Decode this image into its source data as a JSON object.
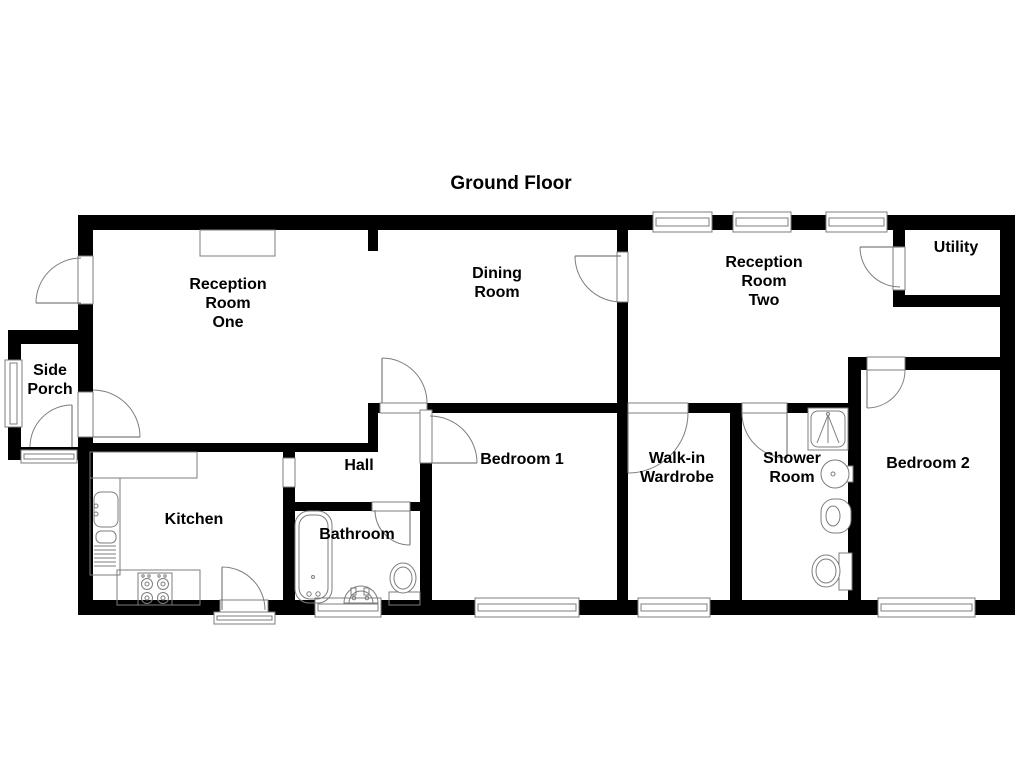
{
  "title": {
    "text": "Ground Floor",
    "x": 511,
    "y": 189
  },
  "colors": {
    "wall": "#000000",
    "line": "#7d7d7d",
    "bg": "#ffffff",
    "text": "#000000"
  },
  "canvas": {
    "w": 1024,
    "h": 768
  },
  "rooms": [
    {
      "id": "reception-room-one",
      "lines": [
        "Reception",
        "Room",
        "One"
      ],
      "x": 228,
      "y": 289
    },
    {
      "id": "dining-room",
      "lines": [
        "Dining",
        "Room"
      ],
      "x": 497,
      "y": 278
    },
    {
      "id": "reception-room-two",
      "lines": [
        "Reception",
        "Room",
        "Two"
      ],
      "x": 764,
      "y": 267
    },
    {
      "id": "utility",
      "lines": [
        "Utility"
      ],
      "x": 956,
      "y": 252
    },
    {
      "id": "side-porch",
      "lines": [
        "Side",
        "Porch"
      ],
      "x": 50,
      "y": 375
    },
    {
      "id": "kitchen",
      "lines": [
        "Kitchen"
      ],
      "x": 194,
      "y": 524
    },
    {
      "id": "hall",
      "lines": [
        "Hall"
      ],
      "x": 359,
      "y": 470
    },
    {
      "id": "bathroom",
      "lines": [
        "Bathroom"
      ],
      "x": 357,
      "y": 539
    },
    {
      "id": "bedroom-1",
      "lines": [
        "Bedroom 1"
      ],
      "x": 522,
      "y": 464
    },
    {
      "id": "walk-in-wardrobe",
      "lines": [
        "Walk-in",
        "Wardrobe"
      ],
      "x": 677,
      "y": 463
    },
    {
      "id": "shower-room",
      "lines": [
        "Shower",
        "Room"
      ],
      "x": 792,
      "y": 463
    },
    {
      "id": "bedroom-2",
      "lines": [
        "Bedroom 2"
      ],
      "x": 928,
      "y": 468
    }
  ],
  "walls": [
    {
      "id": "exterior-top",
      "x": 78,
      "y": 215,
      "w": 937,
      "h": 15
    },
    {
      "id": "exterior-west",
      "x": 78,
      "y": 215,
      "w": 15,
      "h": 400
    },
    {
      "id": "exterior-east",
      "x": 1000,
      "y": 215,
      "w": 15,
      "h": 400
    },
    {
      "id": "exterior-bottom",
      "x": 78,
      "y": 600,
      "w": 937,
      "h": 15
    },
    {
      "id": "porch-top",
      "x": 8,
      "y": 330,
      "w": 78,
      "h": 14
    },
    {
      "id": "porch-west",
      "x": 8,
      "y": 330,
      "w": 13,
      "h": 130
    },
    {
      "id": "porch-bottom",
      "x": 8,
      "y": 447,
      "w": 70,
      "h": 13
    },
    {
      "id": "reception-one-south",
      "x": 85,
      "y": 443,
      "w": 292,
      "h": 9
    },
    {
      "id": "reception-dining-stub",
      "x": 368,
      "y": 230,
      "w": 10,
      "h": 21
    },
    {
      "id": "reception-dining-cap",
      "x": 368,
      "y": 403,
      "w": 10,
      "h": 49
    },
    {
      "id": "kitchen-east",
      "x": 283,
      "y": 452,
      "w": 12,
      "h": 163
    },
    {
      "id": "bathroom-north",
      "x": 295,
      "y": 502,
      "w": 135,
      "h": 9
    },
    {
      "id": "bedroom1-west",
      "x": 420,
      "y": 403,
      "w": 12,
      "h": 212
    },
    {
      "id": "mid-horizontal",
      "x": 368,
      "y": 403,
      "w": 480,
      "h": 10
    },
    {
      "id": "dining-east",
      "x": 617,
      "y": 230,
      "w": 11,
      "h": 173
    },
    {
      "id": "bedroom1-walkin-divider",
      "x": 617,
      "y": 413,
      "w": 11,
      "h": 202
    },
    {
      "id": "walkin-shower-divider",
      "x": 730,
      "y": 413,
      "w": 12,
      "h": 202
    },
    {
      "id": "shower-bedroom2-divider",
      "x": 848,
      "y": 357,
      "w": 13,
      "h": 258
    },
    {
      "id": "bedroom2-north",
      "x": 861,
      "y": 357,
      "w": 146,
      "h": 13
    },
    {
      "id": "utility-west",
      "x": 893,
      "y": 230,
      "w": 12,
      "h": 77
    },
    {
      "id": "utility-south",
      "x": 893,
      "y": 295,
      "w": 114,
      "h": 12
    }
  ],
  "openings": [
    {
      "id": "front-door-opening",
      "x": 78,
      "y": 256,
      "w": 15,
      "h": 48
    },
    {
      "id": "porch-house-opening",
      "x": 78,
      "y": 392,
      "w": 15,
      "h": 45
    },
    {
      "id": "hall-dining-opening",
      "x": 380,
      "y": 403,
      "w": 47,
      "h": 10
    },
    {
      "id": "bedroom1-door-opening",
      "x": 420,
      "y": 410,
      "w": 12,
      "h": 53
    },
    {
      "id": "bathroom-door-opening",
      "x": 372,
      "y": 502,
      "w": 38,
      "h": 9
    },
    {
      "id": "kitchen-hall-opening",
      "x": 283,
      "y": 458,
      "w": 12,
      "h": 29
    },
    {
      "id": "kitchen-back-door-opening",
      "x": 220,
      "y": 600,
      "w": 48,
      "h": 15
    },
    {
      "id": "dining-reception2-opening",
      "x": 617,
      "y": 252,
      "w": 11,
      "h": 50
    },
    {
      "id": "walkin-door-opening",
      "x": 628,
      "y": 403,
      "w": 60,
      "h": 10
    },
    {
      "id": "shower-door-opening",
      "x": 742,
      "y": 403,
      "w": 45,
      "h": 10
    },
    {
      "id": "utility-door-opening",
      "x": 893,
      "y": 247,
      "w": 12,
      "h": 43
    },
    {
      "id": "bedroom2-door-opening",
      "x": 867,
      "y": 357,
      "w": 38,
      "h": 13
    }
  ],
  "windows": [
    {
      "id": "reception2-window-1",
      "x": 653,
      "y": 212,
      "w": 59,
      "h": 20
    },
    {
      "id": "reception2-window-2",
      "x": 733,
      "y": 212,
      "w": 58,
      "h": 20
    },
    {
      "id": "reception2-window-3",
      "x": 826,
      "y": 212,
      "w": 61,
      "h": 20
    },
    {
      "id": "porch-window",
      "x": 5,
      "y": 360,
      "w": 17,
      "h": 67
    },
    {
      "id": "bathroom-window",
      "x": 315,
      "y": 598,
      "w": 66,
      "h": 19
    },
    {
      "id": "bedroom1-window",
      "x": 475,
      "y": 598,
      "w": 104,
      "h": 19
    },
    {
      "id": "walkin-window",
      "x": 638,
      "y": 598,
      "w": 72,
      "h": 19
    },
    {
      "id": "bedroom2-window",
      "x": 878,
      "y": 598,
      "w": 97,
      "h": 19
    },
    {
      "id": "porch-threshold",
      "x": 21,
      "y": 450,
      "w": 56,
      "h": 13
    },
    {
      "id": "kitchen-threshold",
      "x": 214,
      "y": 612,
      "w": 61,
      "h": 12
    }
  ],
  "doors": [
    {
      "id": "front-door",
      "cx": 81,
      "cy": 303,
      "r": 45,
      "a1": 180,
      "a2": 270,
      "leaf": 180
    },
    {
      "id": "porch-exit-door",
      "cx": 72,
      "cy": 447,
      "r": 42,
      "a1": 180,
      "a2": 270,
      "leaf": 270
    },
    {
      "id": "porch-house-door",
      "cx": 93,
      "cy": 437,
      "r": 47,
      "a1": 270,
      "a2": 360,
      "leaf": 360
    },
    {
      "id": "hall-dining-door",
      "cx": 382,
      "cy": 403,
      "r": 45,
      "a1": 270,
      "a2": 360,
      "leaf": 270
    },
    {
      "id": "bedroom1-door",
      "cx": 430,
      "cy": 463,
      "r": 47,
      "a1": 270,
      "a2": 360,
      "leaf": 360
    },
    {
      "id": "bathroom-door",
      "cx": 410,
      "cy": 510,
      "r": 35,
      "a1": 90,
      "a2": 180,
      "leaf": 90
    },
    {
      "id": "kitchen-back-door",
      "cx": 222,
      "cy": 610,
      "r": 43,
      "a1": 270,
      "a2": 360,
      "leaf": 270
    },
    {
      "id": "dining-reception2-door",
      "cx": 621,
      "cy": 256,
      "r": 46,
      "a1": 90,
      "a2": 180,
      "leaf": 180
    },
    {
      "id": "walkin-door",
      "cx": 628,
      "cy": 413,
      "r": 60,
      "a1": 0,
      "a2": 90,
      "leaf": 90
    },
    {
      "id": "shower-door",
      "cx": 787,
      "cy": 413,
      "r": 45,
      "a1": 90,
      "a2": 180,
      "leaf": 90
    },
    {
      "id": "utility-door",
      "cx": 900,
      "cy": 247,
      "r": 40,
      "a1": 90,
      "a2": 180,
      "leaf": 180
    },
    {
      "id": "bedroom2-door",
      "cx": 867,
      "cy": 370,
      "r": 38,
      "a1": 0,
      "a2": 90,
      "leaf": 90
    }
  ],
  "fixtures": [
    {
      "id": "fireplace",
      "type": "rect",
      "x": 200,
      "y": 230,
      "w": 75,
      "h": 26
    },
    {
      "id": "kitchen-counter-top",
      "type": "rect",
      "x": 90,
      "y": 452,
      "w": 107,
      "h": 26
    },
    {
      "id": "kitchen-counter-left",
      "type": "rect",
      "x": 90,
      "y": 478,
      "w": 30,
      "h": 97
    },
    {
      "id": "kitchen-counter-bottom",
      "type": "rect",
      "x": 117,
      "y": 570,
      "w": 83,
      "h": 35
    },
    {
      "id": "kitchen-sink",
      "type": "rrect",
      "x": 94,
      "y": 492,
      "w": 24,
      "h": 35,
      "rx": 7
    },
    {
      "id": "kitchen-sink-drainer",
      "type": "rrect",
      "x": 96,
      "y": 531,
      "w": 20,
      "h": 12,
      "rx": 5
    },
    {
      "id": "kitchen-tap-1",
      "type": "circle",
      "cx": 96,
      "cy": 506,
      "r": 2
    },
    {
      "id": "kitchen-tap-2",
      "type": "circle",
      "cx": 96,
      "cy": 514,
      "r": 2
    },
    {
      "id": "kitchen-hatch-1",
      "type": "line",
      "x1": 94,
      "y1": 546,
      "x2": 116,
      "y2": 546
    },
    {
      "id": "kitchen-hatch-2",
      "type": "line",
      "x1": 94,
      "y1": 550,
      "x2": 116,
      "y2": 550
    },
    {
      "id": "kitchen-hatch-3",
      "type": "line",
      "x1": 94,
      "y1": 554,
      "x2": 116,
      "y2": 554
    },
    {
      "id": "kitchen-hatch-4",
      "type": "line",
      "x1": 94,
      "y1": 558,
      "x2": 116,
      "y2": 558
    },
    {
      "id": "kitchen-hatch-5",
      "type": "line",
      "x1": 94,
      "y1": 562,
      "x2": 116,
      "y2": 562
    },
    {
      "id": "kitchen-hatch-6",
      "type": "line",
      "x1": 94,
      "y1": 566,
      "x2": 116,
      "y2": 566
    },
    {
      "id": "stove",
      "type": "rect",
      "x": 138,
      "y": 573,
      "w": 34,
      "h": 32
    },
    {
      "id": "stove-burner-1",
      "type": "circle",
      "cx": 147,
      "cy": 584,
      "r": 5.5
    },
    {
      "id": "stove-burner-1-dot",
      "type": "circle",
      "cx": 147,
      "cy": 584,
      "r": 2
    },
    {
      "id": "stove-burner-2",
      "type": "circle",
      "cx": 163,
      "cy": 584,
      "r": 5.5
    },
    {
      "id": "stove-burner-2-dot",
      "type": "circle",
      "cx": 163,
      "cy": 584,
      "r": 2
    },
    {
      "id": "stove-burner-3",
      "type": "circle",
      "cx": 147,
      "cy": 598,
      "r": 5.5
    },
    {
      "id": "stove-burner-3-dot",
      "type": "circle",
      "cx": 147,
      "cy": 598,
      "r": 2
    },
    {
      "id": "stove-burner-4",
      "type": "circle",
      "cx": 163,
      "cy": 598,
      "r": 5.5
    },
    {
      "id": "stove-burner-4-dot",
      "type": "circle",
      "cx": 163,
      "cy": 598,
      "r": 2
    },
    {
      "id": "stove-knob-1",
      "type": "circle",
      "cx": 143,
      "cy": 576,
      "r": 1.2
    },
    {
      "id": "stove-knob-2",
      "type": "circle",
      "cx": 149,
      "cy": 576,
      "r": 1.2
    },
    {
      "id": "stove-knob-3",
      "type": "circle",
      "cx": 159,
      "cy": 576,
      "r": 1.2
    },
    {
      "id": "stove-knob-4",
      "type": "circle",
      "cx": 165,
      "cy": 576,
      "r": 1.2
    },
    {
      "id": "bathtub-outer",
      "type": "rrect",
      "x": 295,
      "y": 511,
      "w": 37,
      "h": 92,
      "rx": 14
    },
    {
      "id": "bathtub-inner",
      "type": "rrect",
      "x": 299,
      "y": 515,
      "w": 29,
      "h": 84,
      "rx": 11
    },
    {
      "id": "bathtub-tap-1",
      "type": "circle",
      "cx": 309,
      "cy": 594,
      "r": 2.2
    },
    {
      "id": "bathtub-tap-2",
      "type": "circle",
      "cx": 318,
      "cy": 594,
      "r": 2.2
    },
    {
      "id": "bathtub-drain",
      "type": "circle",
      "cx": 313,
      "cy": 577,
      "r": 1.5
    },
    {
      "id": "basin-outer",
      "type": "path",
      "d": "M 344 603 A 17 17 0 0 1 378 603 Z"
    },
    {
      "id": "basin-inner",
      "type": "path",
      "d": "M 349 603 A 12 12 0 0 1 373 603"
    },
    {
      "id": "basin-tap-1",
      "type": "rect",
      "x": 351,
      "y": 588,
      "w": 5,
      "h": 7
    },
    {
      "id": "basin-tap-2",
      "type": "rect",
      "x": 364,
      "y": 588,
      "w": 5,
      "h": 7
    },
    {
      "id": "basin-dot-1",
      "type": "circle",
      "cx": 354,
      "cy": 598,
      "r": 1.8
    },
    {
      "id": "basin-dot-2",
      "type": "circle",
      "cx": 367,
      "cy": 598,
      "r": 1.8
    },
    {
      "id": "toilet-base",
      "type": "rect",
      "x": 389,
      "y": 592,
      "w": 31,
      "h": 13
    },
    {
      "id": "toilet-bowl",
      "type": "ellipse",
      "cx": 403,
      "cy": 578,
      "rx": 13,
      "ry": 15,
      "fill": "#ffffff"
    },
    {
      "id": "toilet-bowl-inner",
      "type": "ellipse",
      "cx": 403,
      "cy": 578,
      "rx": 9,
      "ry": 11
    },
    {
      "id": "shower-tray",
      "type": "rect",
      "x": 808,
      "y": 408,
      "w": 40,
      "h": 42,
      "fill": "#ffffff"
    },
    {
      "id": "shower-tray-inner",
      "type": "rrect",
      "x": 811,
      "y": 411,
      "w": 34,
      "h": 36,
      "rx": 7
    },
    {
      "id": "shower-line-left",
      "type": "line",
      "x1": 828,
      "y1": 415,
      "x2": 817,
      "y2": 443
    },
    {
      "id": "shower-line-center",
      "type": "line",
      "x1": 828,
      "y1": 415,
      "x2": 828,
      "y2": 443
    },
    {
      "id": "shower-line-right",
      "type": "line",
      "x1": 828,
      "y1": 415,
      "x2": 839,
      "y2": 443
    },
    {
      "id": "shower-head-dot",
      "type": "circle",
      "cx": 828,
      "cy": 414,
      "r": 1.5
    },
    {
      "id": "shower-sink-tap",
      "type": "rect",
      "x": 844,
      "y": 466,
      "w": 9,
      "h": 16,
      "fill": "#ffffff"
    },
    {
      "id": "shower-sink",
      "type": "circle",
      "cx": 835,
      "cy": 474,
      "r": 14,
      "fill": "#ffffff"
    },
    {
      "id": "shower-sink-dot",
      "type": "circle",
      "cx": 833,
      "cy": 474,
      "r": 2
    },
    {
      "id": "bidet",
      "type": "rrect",
      "x": 821,
      "y": 499,
      "w": 30,
      "h": 34,
      "rx": 13,
      "fill": "#ffffff"
    },
    {
      "id": "bidet-inner",
      "type": "ellipse",
      "cx": 833,
      "cy": 516,
      "rx": 7,
      "ry": 10
    },
    {
      "id": "toilet2-tank",
      "type": "rect",
      "x": 839,
      "y": 553,
      "w": 13,
      "h": 37,
      "fill": "#ffffff"
    },
    {
      "id": "toilet2-bowl",
      "type": "ellipse",
      "cx": 826,
      "cy": 571,
      "rx": 14,
      "ry": 16,
      "fill": "#ffffff"
    },
    {
      "id": "toilet2-bowl-inner",
      "type": "ellipse",
      "cx": 826,
      "cy": 571,
      "rx": 10,
      "ry": 12
    }
  ]
}
